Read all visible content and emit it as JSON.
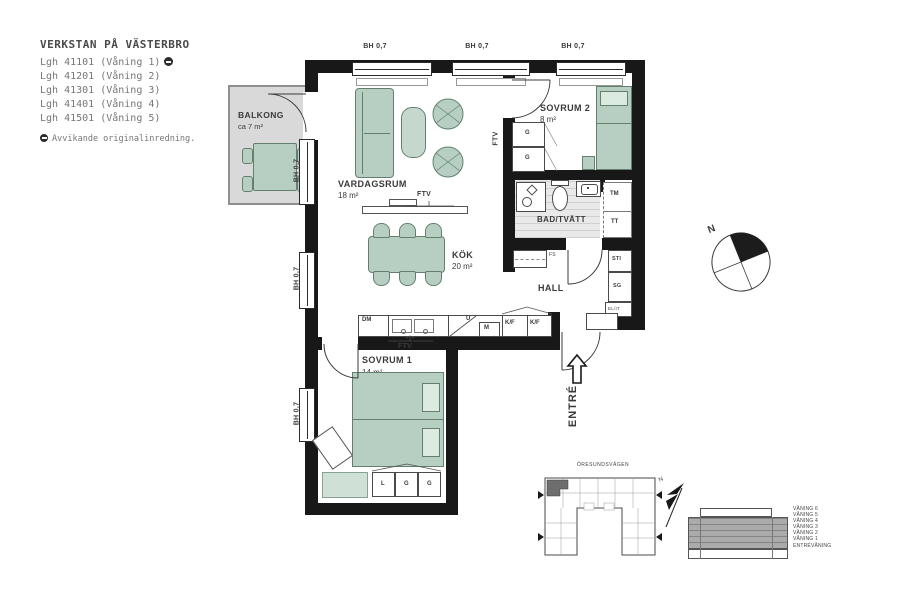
{
  "header": {
    "title": "VERKSTAN PÅ VÄSTERBRO",
    "apartments": [
      "Lgh 41101 (Våning 1)",
      "Lgh 41201 (Våning 2)",
      "Lgh 41301 (Våning 3)",
      "Lgh 41401 (Våning 4)",
      "Lgh 41501 (Våning 5)"
    ],
    "note": "Avvikande originalinredning."
  },
  "plan": {
    "window_label": "BH 0,7",
    "rooms": {
      "balkong": {
        "name": "BALKONG",
        "area": "ca 7 m²"
      },
      "vardagsrum": {
        "name": "VARDAGSRUM",
        "area": "18 m²"
      },
      "sovrum2": {
        "name": "SOVRUM 2",
        "area": "8 m²"
      },
      "bad": {
        "name": "BAD/TVÄTT"
      },
      "kok": {
        "name": "KÖK",
        "area": "20 m²"
      },
      "hall": {
        "name": "HALL"
      },
      "sovrum1": {
        "name": "SOVRUM 1",
        "area": "14 m²"
      }
    },
    "fixtures": {
      "ftv": "FTV",
      "dm": "DM",
      "u": "U",
      "m": "M",
      "kf": "K/F",
      "g": "G",
      "l": "L",
      "tm": "TM",
      "tt": "TT",
      "sti": "STI",
      "sg": "SG",
      "elit": "EL/IT",
      "fs": "FS"
    },
    "entre": "ENTRÉ",
    "north": "N"
  },
  "siteplan": {
    "street": "ÖRESUNDSVÄGEN",
    "north": "N"
  },
  "elevation": {
    "floors": [
      "VÅNING 6",
      "VÅNING 5",
      "VÅNING 4",
      "VÅNING 3",
      "VÅNING 2",
      "VÅNING 1",
      "ENTRÉVÅNING"
    ]
  },
  "colors": {
    "wall": "#181818",
    "furniture_green": "#b7cfc2",
    "balcony_gray": "#d9d9d9",
    "site_highlight": "#6e6e6e"
  }
}
